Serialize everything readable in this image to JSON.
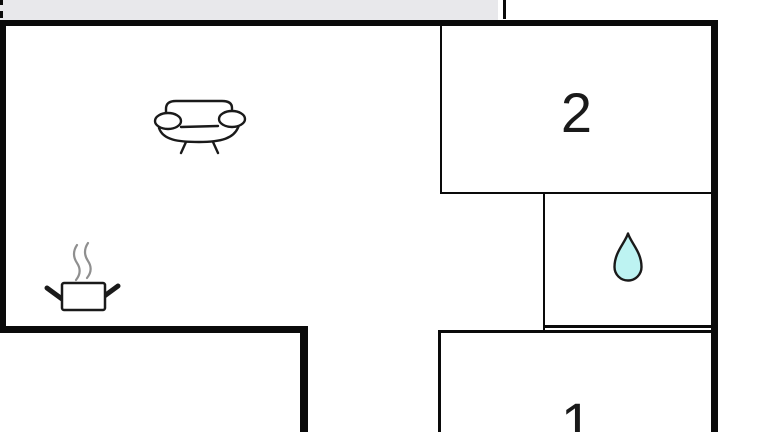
{
  "colors": {
    "background": "#ffffff",
    "wall": "#0a0a0a",
    "top_bar": "#e8e8eb",
    "drop_fill": "#bdf3f2",
    "icon_stroke": "#1a1a1a",
    "steam": "#8f8f8f",
    "label": "#1a1a1a"
  },
  "rooms": {
    "bedroom2": {
      "label": "2"
    },
    "bedroom1": {
      "label": "1"
    },
    "living_room": {
      "icon": "sofa-icon"
    },
    "kitchen": {
      "icon": "cooking-pot-icon"
    },
    "bathroom": {
      "icon": "water-drop-icon"
    }
  }
}
